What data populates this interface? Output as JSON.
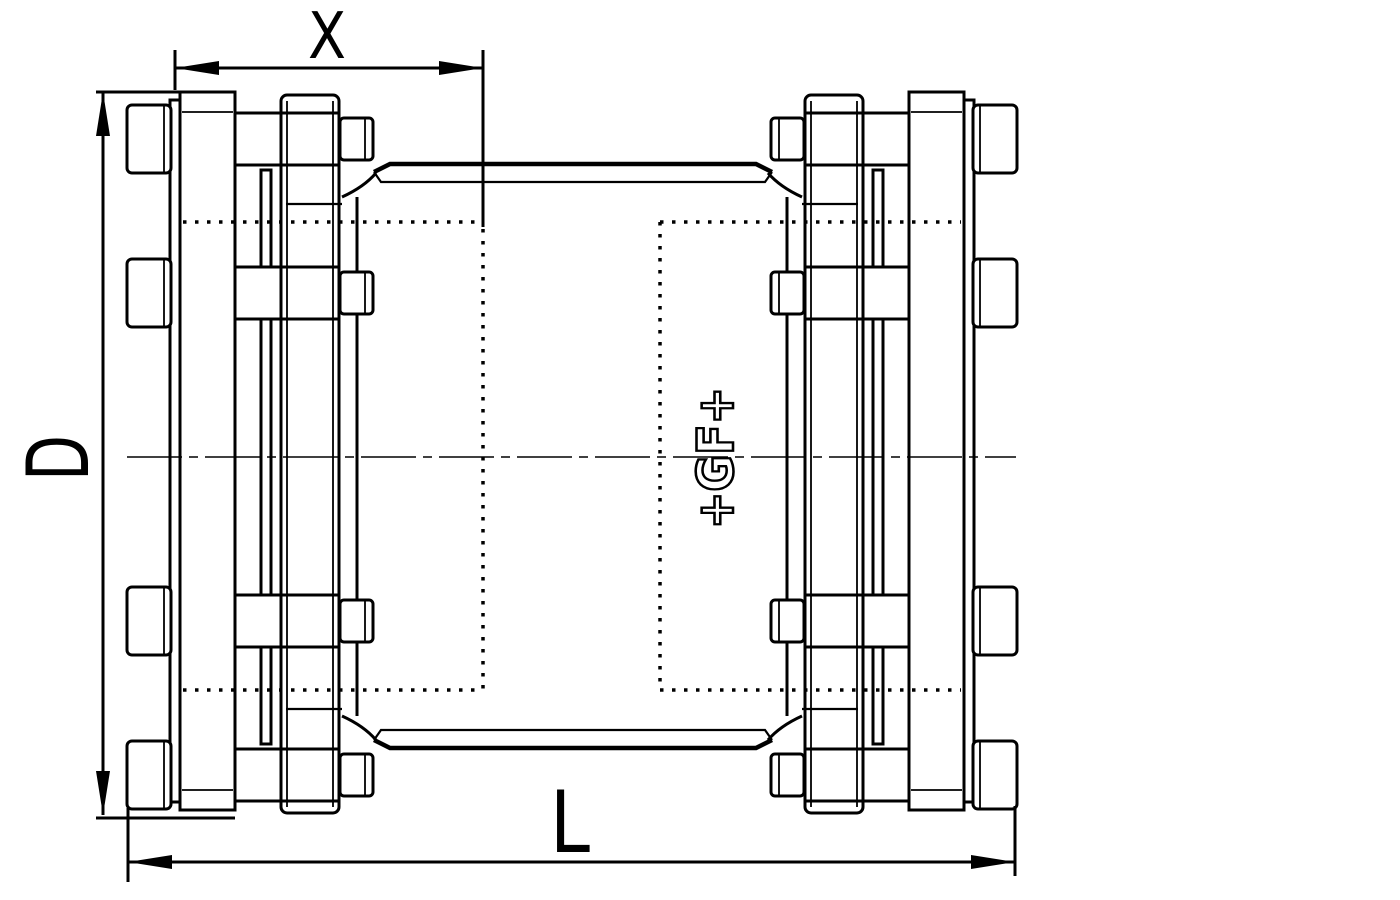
{
  "drawing": {
    "kind": "technical-dimension-drawing",
    "subject": "pipe-coupling-side-view",
    "colors": {
      "line": "#000000",
      "background": "#ffffff"
    },
    "labels": {
      "dim_insertion_depth": "X",
      "dim_outer_diameter": "D",
      "dim_overall_length": "L"
    },
    "logo": {
      "text": "+GF+"
    }
  }
}
